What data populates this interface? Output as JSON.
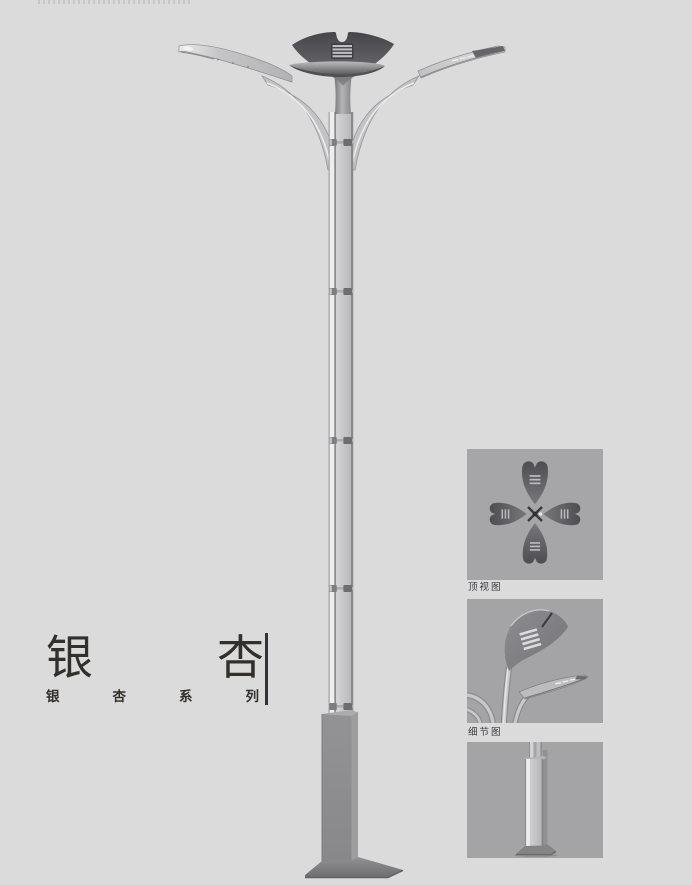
{
  "page": {
    "background_color": "#dbdbdc",
    "panel_background_color": "#a6a6a8",
    "title_text_color": "#332f2b"
  },
  "title": {
    "char_1": "银",
    "char_2": "杏",
    "series_chars": [
      "银",
      "杏",
      "系",
      "列"
    ],
    "series_label": "银杏系列"
  },
  "panels": [
    {
      "name": "top-view",
      "caption": "顶视图"
    },
    {
      "name": "detail-view",
      "caption": "细节图"
    },
    {
      "name": "base-view",
      "caption": ""
    }
  ],
  "illustration": {
    "subject": "ginkgo-leaf double-arm street light pole",
    "crown_color": "#4c4c51",
    "pole_light_color": "#c9c9cb",
    "pole_edge_color": "#8d8d90",
    "base_color": "#8e8e90",
    "joint_count": 4
  }
}
